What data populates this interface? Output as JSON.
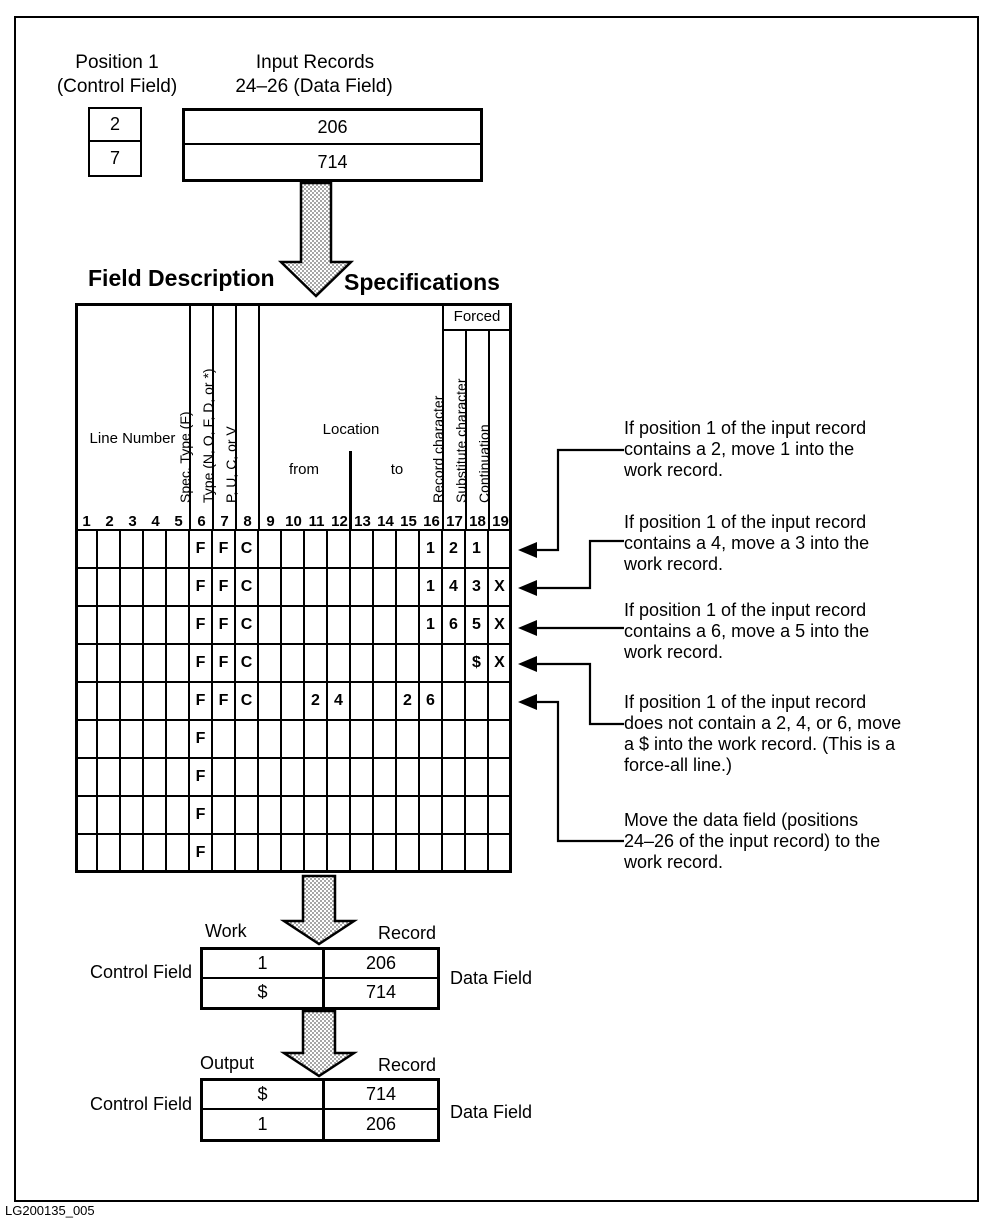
{
  "input_section": {
    "position_label": [
      "Position 1",
      "(Control Field)"
    ],
    "records_label": [
      "Input Records",
      "24–26 (Data Field)"
    ],
    "control_values": [
      "2",
      "7"
    ],
    "data_values": [
      "206",
      "714"
    ]
  },
  "spec_grid": {
    "title_left": "Field Description",
    "title_right": "Specifications",
    "header": {
      "line_number": "Line Number",
      "spec_type": "Spec. Type (F)",
      "type": "Type (N, O, F, D, or *)",
      "pucv": "P, U, C, or V",
      "location": "Location",
      "from": "from",
      "to": "to",
      "forced": "Forced",
      "record_character": "Record character",
      "substitute_character": "Substitute character",
      "continuation": "Continuation"
    },
    "column_numbers": [
      "1",
      "2",
      "3",
      "4",
      "5",
      "6",
      "7",
      "8",
      "9",
      "10",
      "11",
      "12",
      "13",
      "14",
      "15",
      "16",
      "17",
      "18",
      "19"
    ],
    "rows": [
      {
        "6": "F",
        "7": "F",
        "8": "C",
        "16": "1",
        "17": "2",
        "18": "1"
      },
      {
        "6": "F",
        "7": "F",
        "8": "C",
        "16": "1",
        "17": "4",
        "18": "3",
        "19": "X"
      },
      {
        "6": "F",
        "7": "F",
        "8": "C",
        "16": "1",
        "17": "6",
        "18": "5",
        "19": "X"
      },
      {
        "6": "F",
        "7": "F",
        "8": "C",
        "18": "$",
        "19": "X"
      },
      {
        "6": "F",
        "7": "F",
        "8": "C",
        "11": "2",
        "12": "4",
        "15": "2",
        "16": "6"
      },
      {
        "6": "F"
      },
      {
        "6": "F"
      },
      {
        "6": "F"
      },
      {
        "6": "F"
      }
    ]
  },
  "annotations": [
    {
      "lines": [
        "If position 1 of the input record",
        "contains a 2, move 1 into the",
        "work record."
      ]
    },
    {
      "lines": [
        "If position 1 of the input record",
        "contains a 4, move a 3 into the",
        "work record."
      ]
    },
    {
      "lines": [
        "If position 1 of the input record",
        "contains a 6, move a 5 into the",
        "work record."
      ]
    },
    {
      "lines": [
        "If position 1 of the input record",
        "does not contain a 2, 4, or 6, move",
        "a $ into the work record.  (This is a",
        "force-all line.)"
      ]
    },
    {
      "lines": [
        "Move the data field (positions",
        "24–26 of the input record) to the",
        "work record."
      ]
    }
  ],
  "work_section": {
    "label_left": "Work",
    "label_right": "Record",
    "row_label_left": "Control Field",
    "row_label_right": "Data Field",
    "rows": [
      [
        "1",
        "206"
      ],
      [
        "$",
        "714"
      ]
    ]
  },
  "output_section": {
    "label_left": "Output",
    "label_right": "Record",
    "row_label_left": "Control Field",
    "row_label_right": "Data Field",
    "rows": [
      [
        "$",
        "714"
      ],
      [
        "1",
        "206"
      ]
    ]
  },
  "footer": {
    "figure_id": "LG200135_005"
  }
}
